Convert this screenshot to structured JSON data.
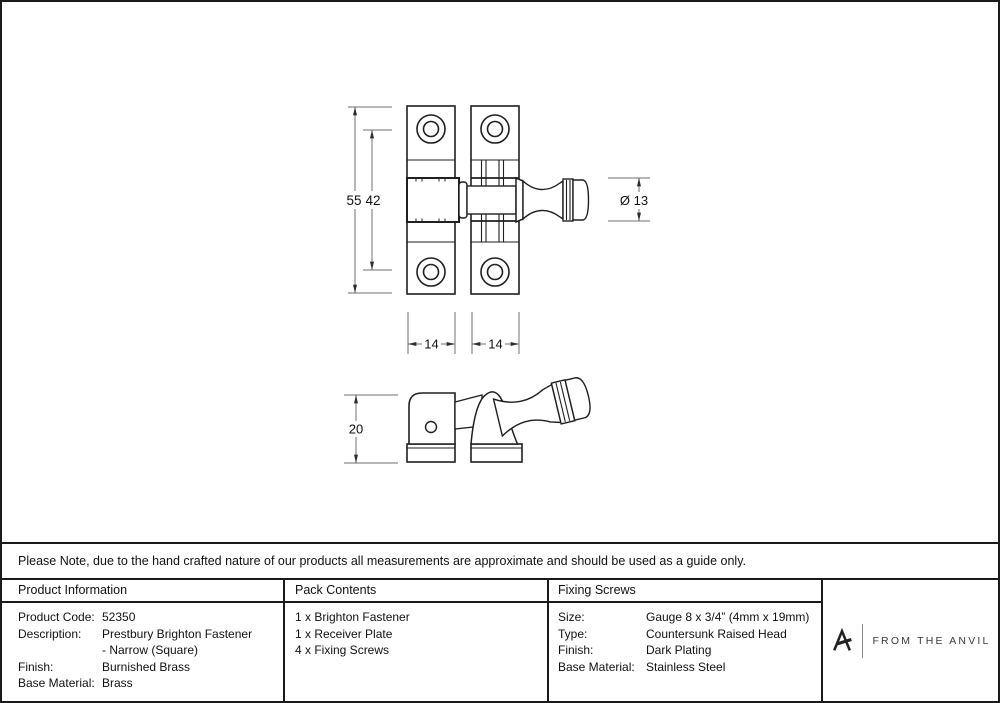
{
  "drawing": {
    "front_view_dims": {
      "overall_height": "55",
      "hole_spacing": "42",
      "knob_diameter": "Ø 13",
      "left_plate_width": "14",
      "right_plate_width": "14"
    },
    "side_view_dims": {
      "depth": "20"
    }
  },
  "note_bar": {
    "text": "Please Note, due to the hand crafted nature of our products all measurements are approximate and should be used as a guide only."
  },
  "product_information": {
    "header": "Product Information",
    "rows": [
      {
        "label": "Product Code:",
        "value": "52350"
      },
      {
        "label": "Description:",
        "value": "Prestbury Brighton Fastener"
      },
      {
        "label": "",
        "value": "- Narrow (Square)"
      },
      {
        "label": "Finish:",
        "value": "Burnished Brass"
      },
      {
        "label": "Base Material:",
        "value": "Brass"
      }
    ]
  },
  "pack_contents": {
    "header": "Pack Contents",
    "items": [
      "1 x Brighton Fastener",
      "1 x Receiver Plate",
      "4 x Fixing Screws"
    ]
  },
  "fixing_screws": {
    "header": "Fixing Screws",
    "rows": [
      {
        "label": "Size:",
        "value": "Gauge 8 x 3/4” (4mm x 19mm)"
      },
      {
        "label": "Type:",
        "value": "Countersunk Raised Head"
      },
      {
        "label": "Finish:",
        "value": "Dark Plating"
      },
      {
        "label": "Base Material:",
        "value": "Stainless Steel"
      }
    ]
  },
  "logo": {
    "brand": "FROM THE ANVIL"
  }
}
